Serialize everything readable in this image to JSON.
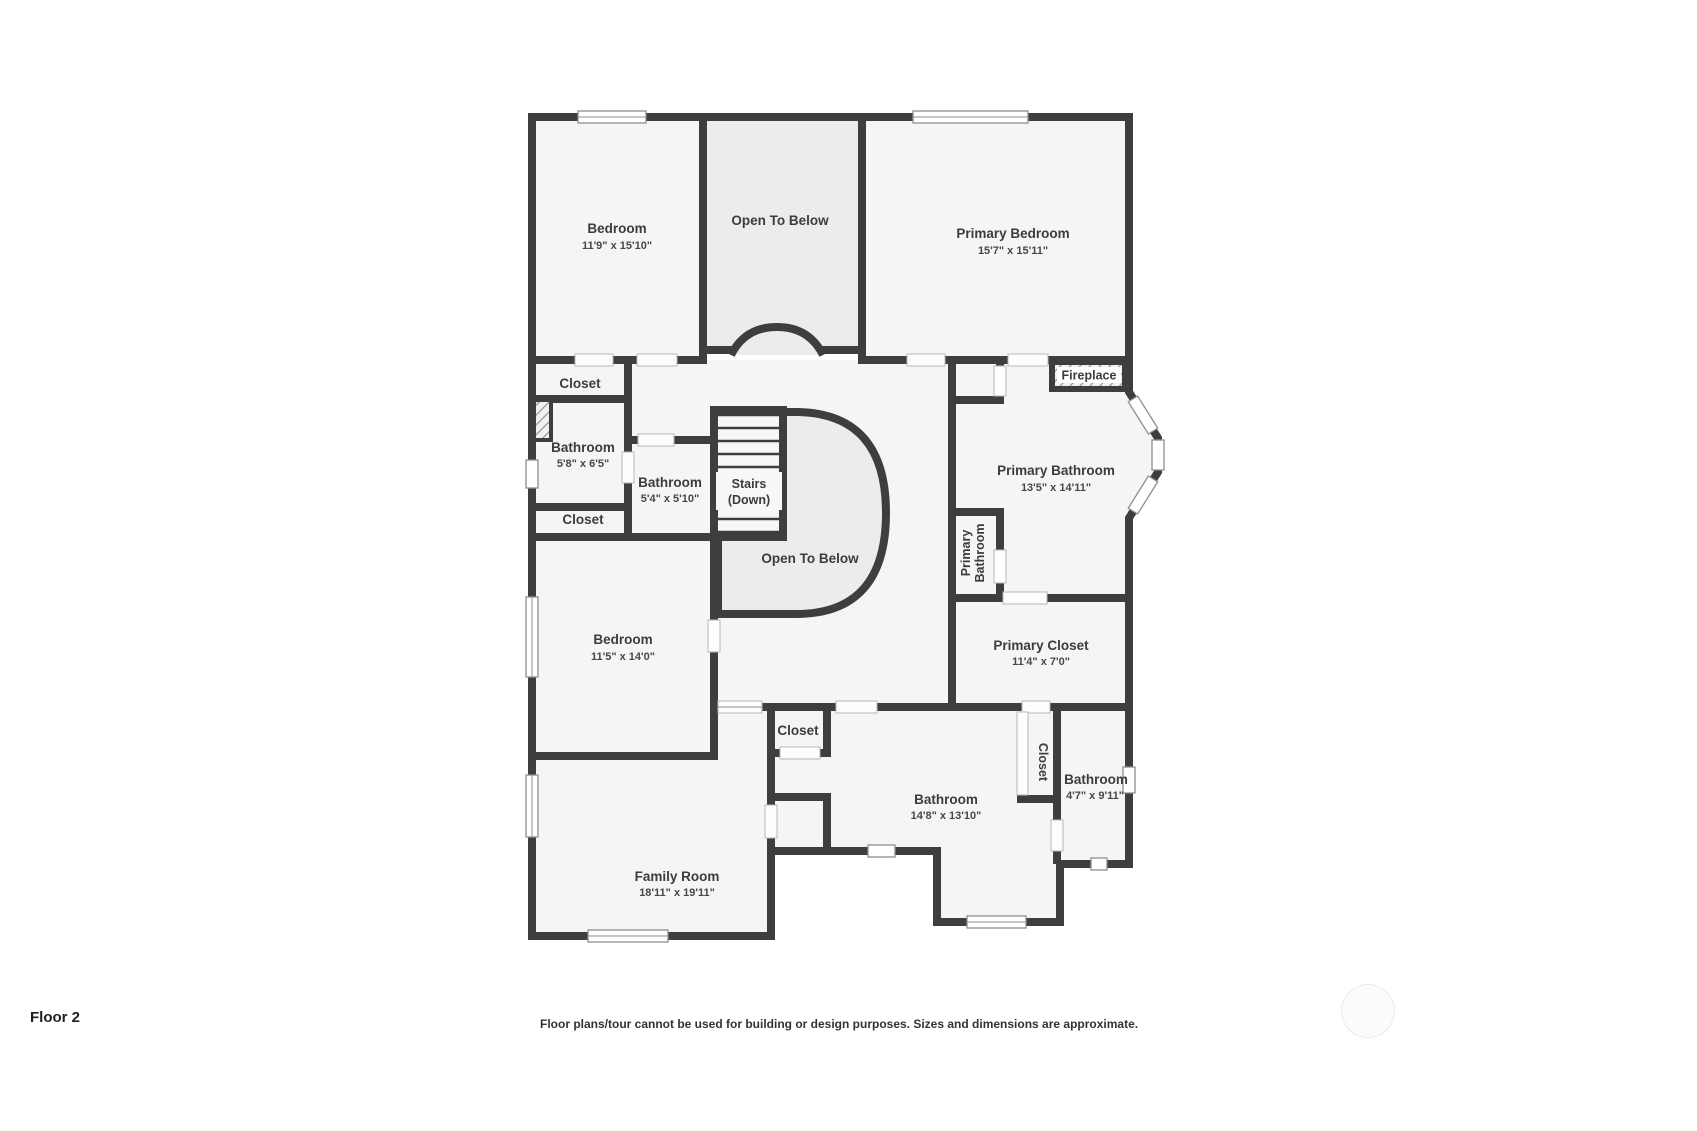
{
  "page": {
    "floor_label": "Floor 2",
    "disclaimer": "Floor plans/tour cannot be used for building or design purposes. Sizes and dimensions are approximate."
  },
  "colors": {
    "wall": "#3e3e3e",
    "room_fill": "#f5f5f4",
    "open_area_fill": "#ececeb",
    "label_text": "#3c3c3c"
  },
  "rooms": [
    {
      "id": "bedroom-top",
      "label": "Bedroom",
      "sublabel": "11'9\" x 15'10\""
    },
    {
      "id": "open-to-below-top",
      "label": "Open To Below",
      "sublabel": ""
    },
    {
      "id": "primary-bedroom",
      "label": "Primary Bedroom",
      "sublabel": "15'7\" x 15'11\""
    },
    {
      "id": "closet-top",
      "label": "Closet",
      "sublabel": ""
    },
    {
      "id": "bathroom-left-small",
      "label": "Bathroom",
      "sublabel": "5'8\" x 6'5\""
    },
    {
      "id": "bathroom-hall",
      "label": "Bathroom",
      "sublabel": "5'4\" x 5'10\""
    },
    {
      "id": "stairs",
      "label": "Stairs",
      "sublabel": "(Down)"
    },
    {
      "id": "closet-mid",
      "label": "Closet",
      "sublabel": ""
    },
    {
      "id": "open-to-below-mid",
      "label": "Open To Below",
      "sublabel": ""
    },
    {
      "id": "bedroom-mid",
      "label": "Bedroom",
      "sublabel": "11'5\" x 14'0\""
    },
    {
      "id": "fireplace",
      "label": "Fireplace",
      "sublabel": ""
    },
    {
      "id": "primary-bathroom",
      "label": "Primary Bathroom",
      "sublabel": "13'5\" x 14'11\""
    },
    {
      "id": "primary-bathroom-wc",
      "label": "Primary",
      "sublabel": "Bathroom"
    },
    {
      "id": "primary-closet",
      "label": "Primary Closet",
      "sublabel": "11'4\" x 7'0\""
    },
    {
      "id": "closet-bottom",
      "label": "Closet",
      "sublabel": ""
    },
    {
      "id": "bathroom-bonus",
      "label": "Bathroom",
      "sublabel": "14'8\" x 13'10\""
    },
    {
      "id": "closet-vertical",
      "label": "Closet",
      "sublabel": ""
    },
    {
      "id": "bathroom-right-small",
      "label": "Bathroom",
      "sublabel": "4'7\" x 9'11\""
    },
    {
      "id": "family-room",
      "label": "Family Room",
      "sublabel": "18'11\" x 19'11\""
    }
  ]
}
